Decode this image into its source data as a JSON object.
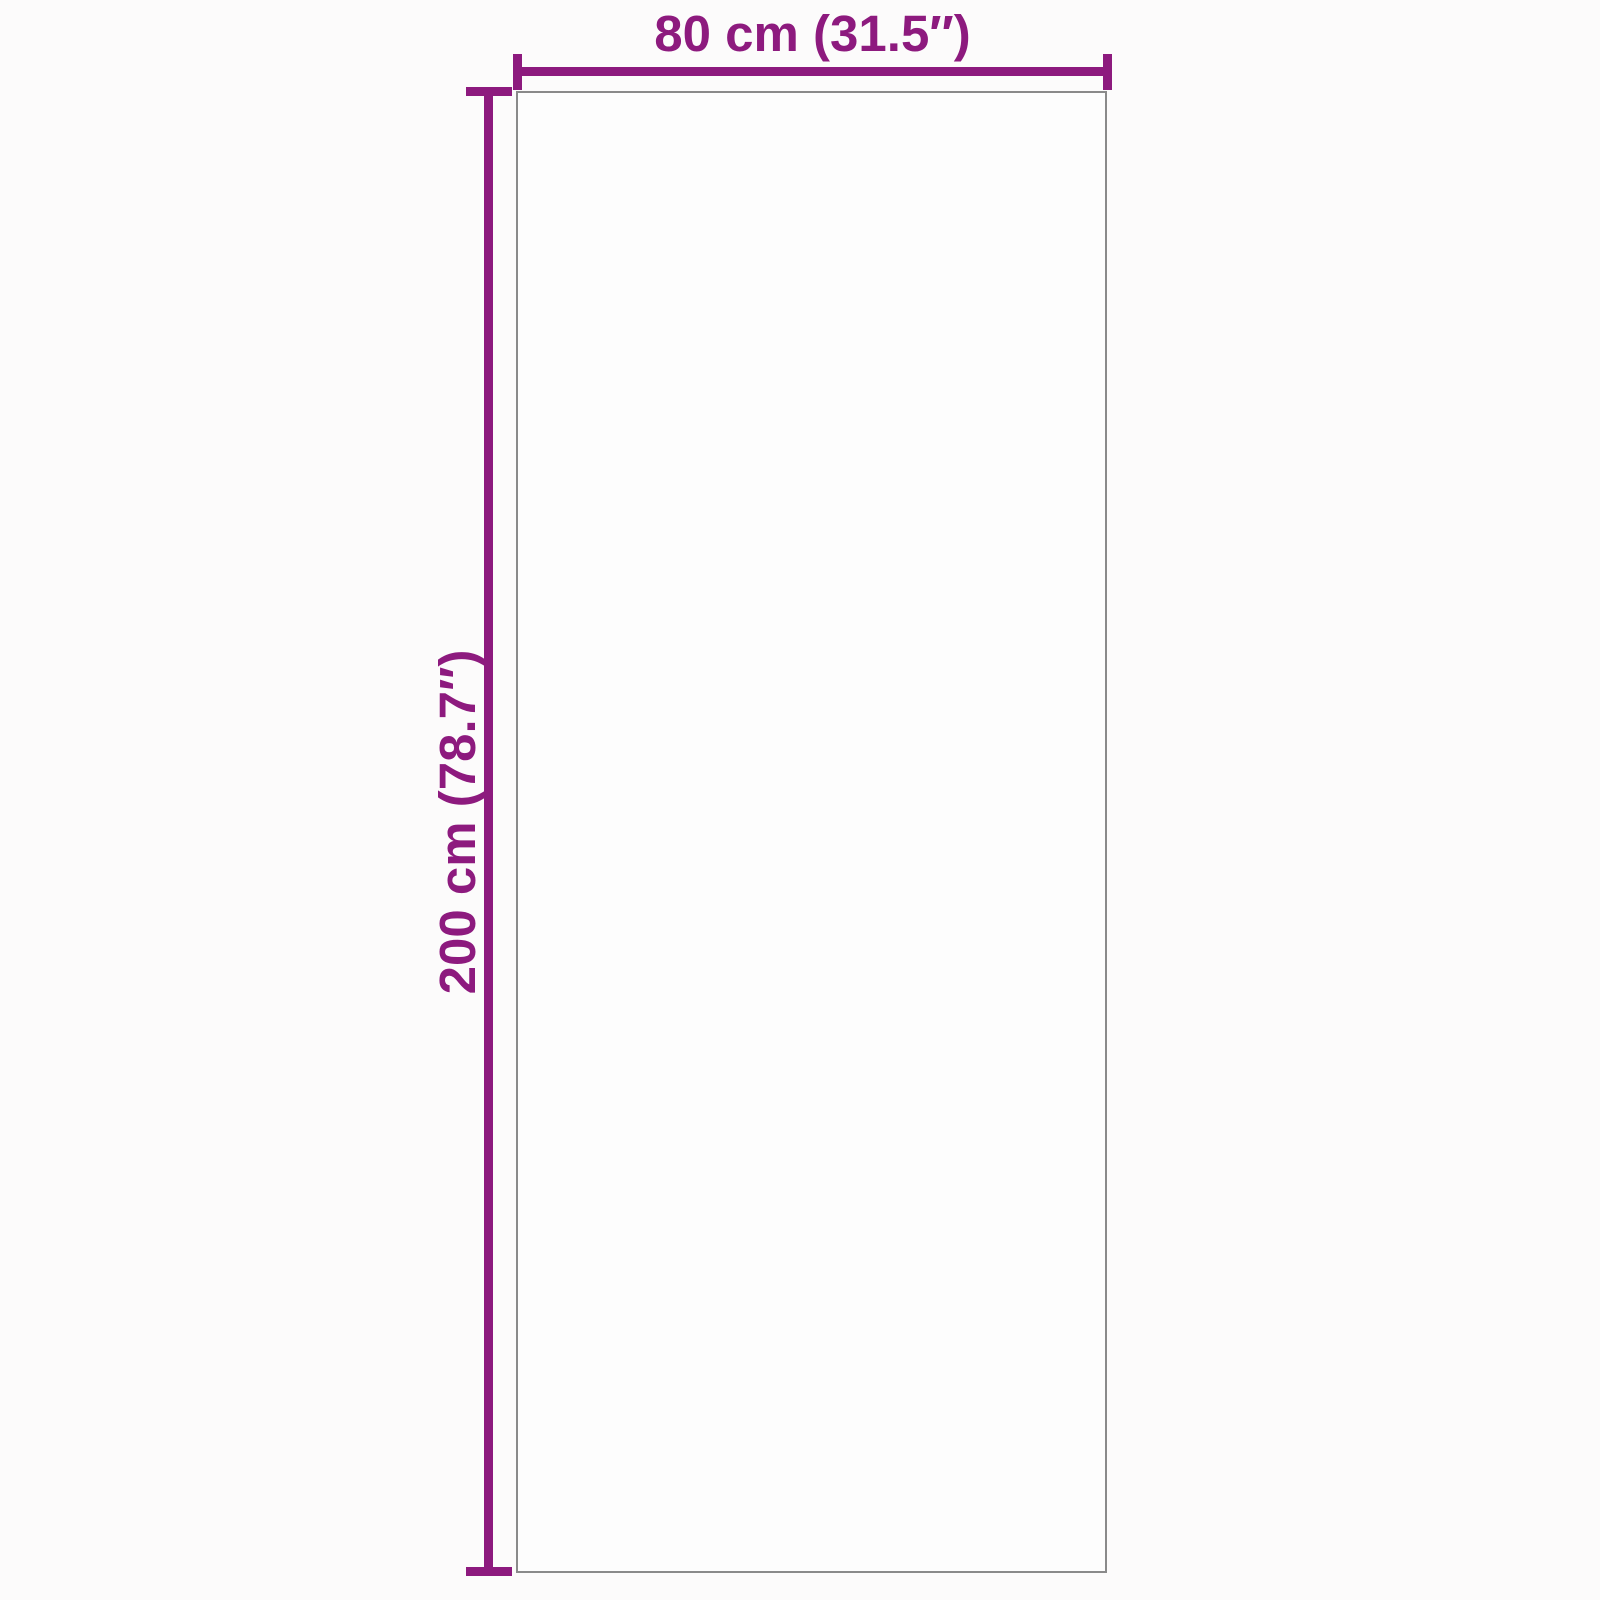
{
  "diagram": {
    "type": "product-dimension-diagram",
    "shape": "rectangle",
    "dimensions": {
      "width_label": "80 cm (31.5″)",
      "height_label": "200 cm (78.7″)",
      "width_cm": 80,
      "height_cm": 200,
      "width_inches": 31.5,
      "height_inches": 78.7
    },
    "colors": {
      "accent": "#8D1A7E",
      "outline": "#8A8A8A",
      "background": "#FCFBFB"
    }
  }
}
